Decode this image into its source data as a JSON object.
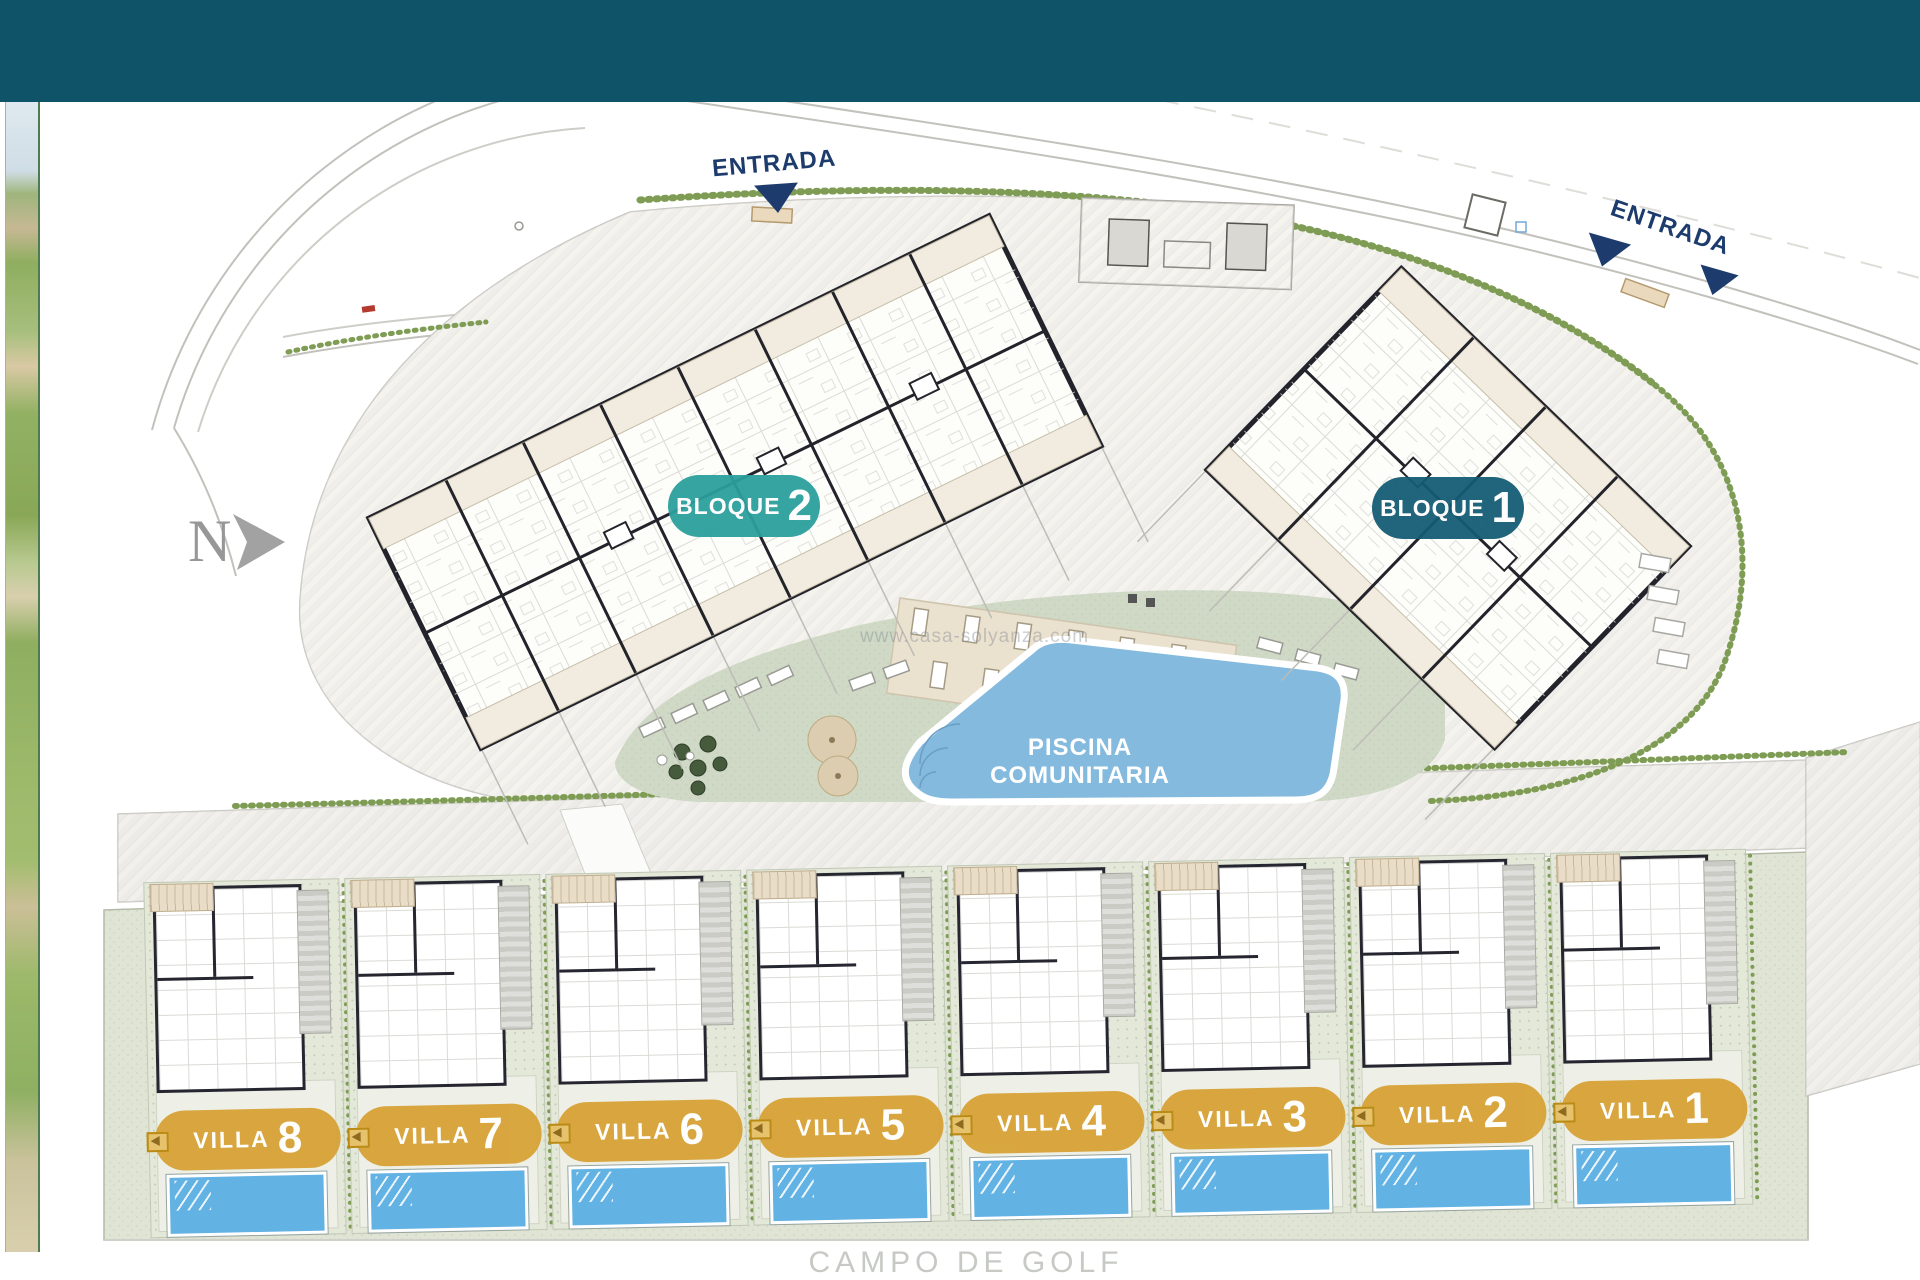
{
  "colors": {
    "header_bg": "#0e5368",
    "entrance_navy": "#1d3c6d",
    "parcel_paving": "#f4f3ef",
    "lawn_green": "#cfd9c6",
    "hedge_green": "#7f9c55"
  },
  "entrances": [
    {
      "label": "ENTRADA"
    },
    {
      "label": "ENTRADA"
    }
  ],
  "north": {
    "label": "N"
  },
  "watermark": "www.casa-solyanza.com",
  "blocks": [
    {
      "label": "BLOQUE",
      "number": "2",
      "badge_color": "#2aa09d"
    },
    {
      "label": "BLOQUE",
      "number": "1",
      "badge_color": "#135c74"
    }
  ],
  "pool": {
    "label": "PISCINA COMUNITARIA",
    "water_color": "#83bade"
  },
  "villas": {
    "label": "VILLA",
    "numbers": [
      "8",
      "7",
      "6",
      "5",
      "4",
      "3",
      "2",
      "1"
    ],
    "badge_color": "#d7a237",
    "pool_color": "#62b2e4"
  },
  "golf": {
    "label": "CAMPO DE GOLF"
  }
}
